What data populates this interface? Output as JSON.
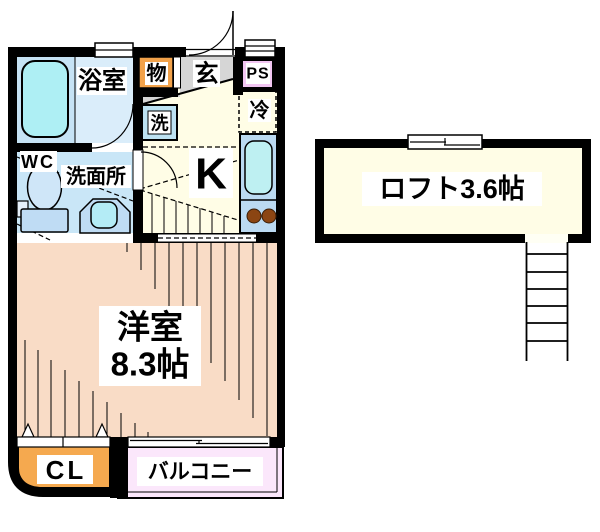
{
  "floor_plan": {
    "rooms": {
      "bathroom": {
        "label": "浴室"
      },
      "storage": {
        "label": "物"
      },
      "entrance": {
        "label": "玄"
      },
      "pipe_space": {
        "label": "PS"
      },
      "refrigerator": {
        "label": "冷"
      },
      "washing_machine": {
        "label": "洗"
      },
      "wc": {
        "label": "WC"
      },
      "washroom": {
        "label": "洗面所"
      },
      "kitchen": {
        "label": "K"
      },
      "western_room": {
        "label": "洋室",
        "size": "8.3帖"
      },
      "closet": {
        "label": "CL"
      },
      "balcony": {
        "label": "バルコニー"
      },
      "loft": {
        "label": "ロフト3.6帖"
      }
    },
    "colors": {
      "wall": "#000000",
      "bathroom_floor_left": "#C6E3F5",
      "bathroom_floor_right": "#DAEDFA",
      "bathtub": "#AEEFF4",
      "storage": "#F2A24A",
      "entrance": "#D6D6D6",
      "pipe_space": "#F2C6F2",
      "kitchen_floor": "#FFFDE6",
      "counter": "#BBDAF2",
      "sink": "#BEF0F2",
      "burner": "#8B4513",
      "wc_floor": "#C9E6F7",
      "toilet_bowl": "#CFE6F8",
      "toilet_tank": "#BFDCF4",
      "basin": "#B4ECF6",
      "washer": "#BDE2F2",
      "western_room_floor": "#F9DCC6",
      "closet": "#F5A94F",
      "balcony": "#FBE7FB",
      "loft_floor": "#FFFDE6"
    }
  }
}
